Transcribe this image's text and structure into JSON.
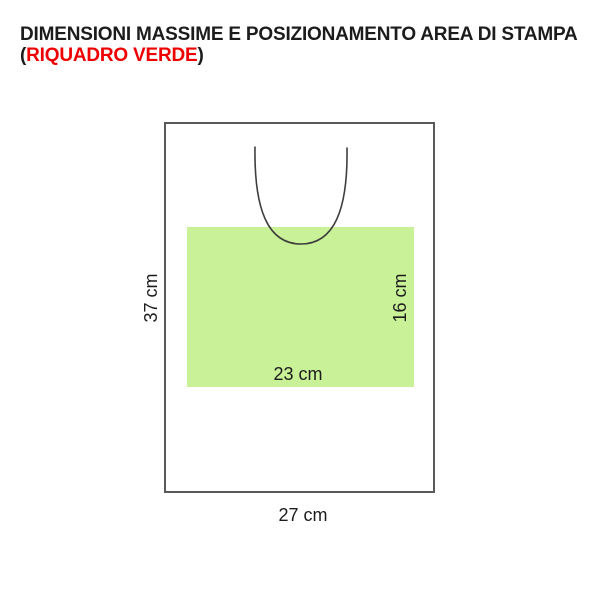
{
  "title": {
    "line1": "DIMENSIONI MASSIME E POSIZIONAMENTO AREA DI STAMPA",
    "line2_open_paren": "(",
    "line2_highlight": "RIQUADRO VERDE",
    "line2_close_paren": ")"
  },
  "diagram": {
    "bag": {
      "width_label": "27 cm",
      "height_label": "37 cm"
    },
    "print_area": {
      "width_label": "23 cm",
      "height_label": "16 cm"
    }
  },
  "colors": {
    "print_area_green": "#c9f197",
    "highlight_red": "#ee0000",
    "outline_gray": "#58595b",
    "text_black": "#1c1c1c"
  }
}
